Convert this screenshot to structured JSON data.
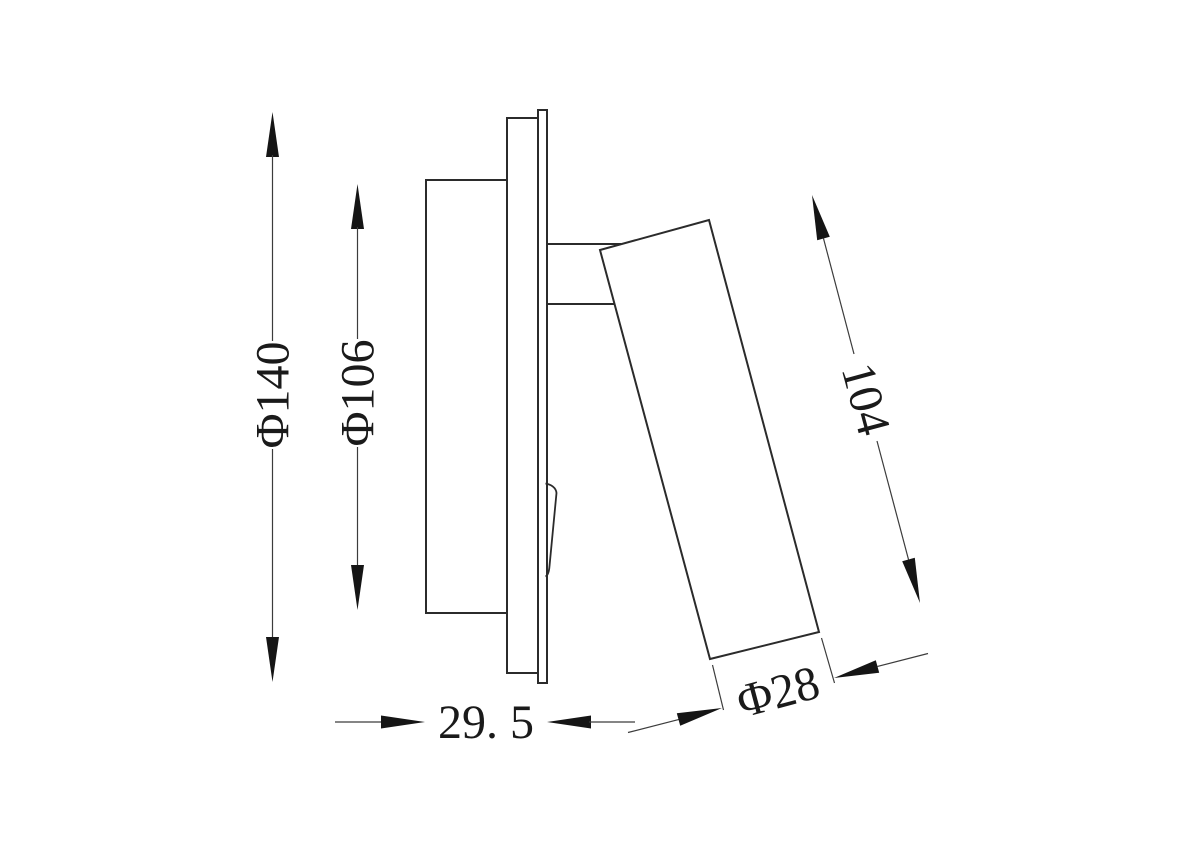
{
  "drawing": {
    "title": "recessed-wall-spotlight-side-view",
    "colors": {
      "background": "#ffffff",
      "outline": "#2b2b2b",
      "dimension_lines": "#3c3c3c",
      "text": "#1a1a1a"
    },
    "dimensions": {
      "faceplate_diameter": {
        "label": "Φ140",
        "value": 140
      },
      "housing_diameter": {
        "label": "Φ106",
        "value": 106
      },
      "head_length": {
        "label": "104",
        "value": 104
      },
      "head_diameter": {
        "label": "Φ28",
        "value": 28
      },
      "mounting_depth": {
        "label": "29. 5",
        "value": 29.5
      }
    }
  }
}
